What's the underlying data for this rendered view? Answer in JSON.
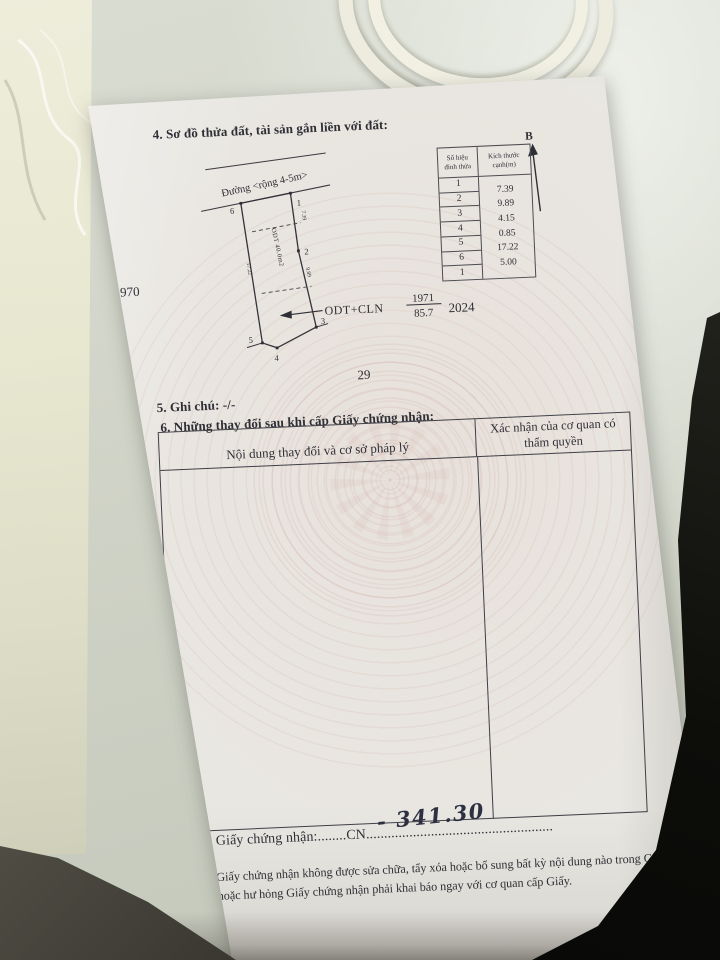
{
  "document": {
    "section4": {
      "title": "4. Sơ đồ thửa đất, tài sản gắn liền với đất:",
      "diagram": {
        "street_label": "Đường <rộng 4-5m>",
        "neighbor_left": "1970",
        "neighbor_right": "2024",
        "neighbor_bottom": "29",
        "land_use_label": "ODT+CLN",
        "parcel_number": "1971",
        "area_m2": "85.7",
        "inner_label": "ODT 40.0m2",
        "vertex_labels": [
          "1",
          "2",
          "3",
          "4",
          "5",
          "6"
        ],
        "edge_marks": {
          "right_upper": "7.39",
          "right_lower": "9.89",
          "left_side": "17.22"
        },
        "north_label": "B"
      },
      "edge_table": {
        "header_col1_line1": "Số hiệu",
        "header_col1_line2": "đỉnh thửa",
        "header_col2_line1": "Kích thước",
        "header_col2_line2": "cạnh(m)",
        "vertex_sequence": [
          "1",
          "2",
          "3",
          "4",
          "5",
          "6",
          "1"
        ],
        "edge_lengths": [
          "7.39",
          "9.89",
          "4.15",
          "0.85",
          "17.22",
          "5.00"
        ]
      }
    },
    "section5": {
      "title": "5. Ghi chú: -/-"
    },
    "section6": {
      "title": "6. Những thay đổi sau khi cấp Giấy chứng nhận:",
      "table": {
        "col1_header": "Nội dung thay đổi và cơ sở pháp lý",
        "col2_header": "Xác nhận của cơ quan có thẩm quyền"
      }
    },
    "registry_line": {
      "label": "Số vào sổ cấp Giấy chứng nhận:",
      "dots_before_code": "........",
      "code": "CN",
      "dots_after_code": "....................................................",
      "handwritten_number": "- 341.30"
    },
    "footer_note": "Người được cấp Giấy chứng nhận không được sửa chữa, tẩy xóa hoặc bổ sung bất kỳ nội dung nào trong Giấy chứng nhận; khi bị mất hoặc hư hỏng Giấy chứng nhận phải khai báo ngay với cơ quan cấp Giấy."
  },
  "colors": {
    "paper": "#e9e7e2",
    "ink": "#2f2f36",
    "table_surface": "#cfd3c6",
    "shadow_dark": "#0b0b09",
    "watermark_tint": "#cba49a"
  }
}
